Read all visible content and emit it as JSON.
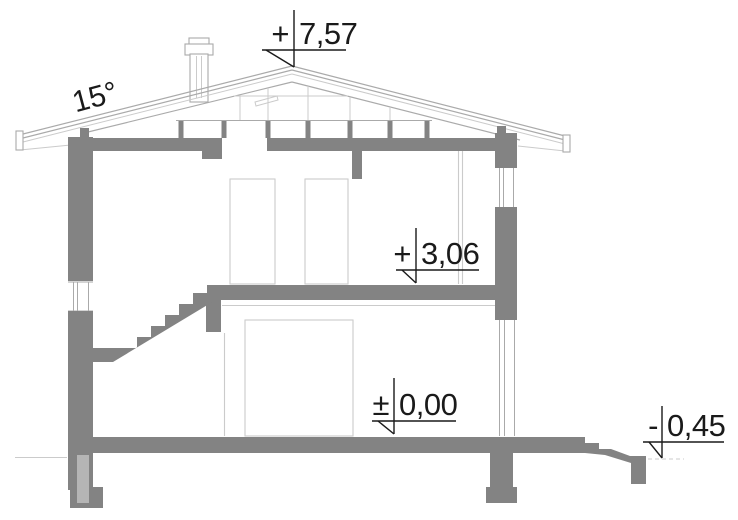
{
  "roof_angle": {
    "label": "15°"
  },
  "levels": [
    {
      "name": "ridge",
      "sign": "+",
      "value": "7,57"
    },
    {
      "name": "upper-floor",
      "sign": "+",
      "value": "3,06"
    },
    {
      "name": "ground-floor",
      "sign": "±",
      "value": "0,00"
    },
    {
      "name": "exterior-grade",
      "sign": "-",
      "value": "0,45"
    }
  ],
  "colors": {
    "wall_fill": "#838383",
    "light_fill": "#b5b5b5",
    "line_thin": "#aaaaaa",
    "line_faint": "#cbcbcb",
    "text": "#1a1a1a",
    "background": "#ffffff"
  }
}
